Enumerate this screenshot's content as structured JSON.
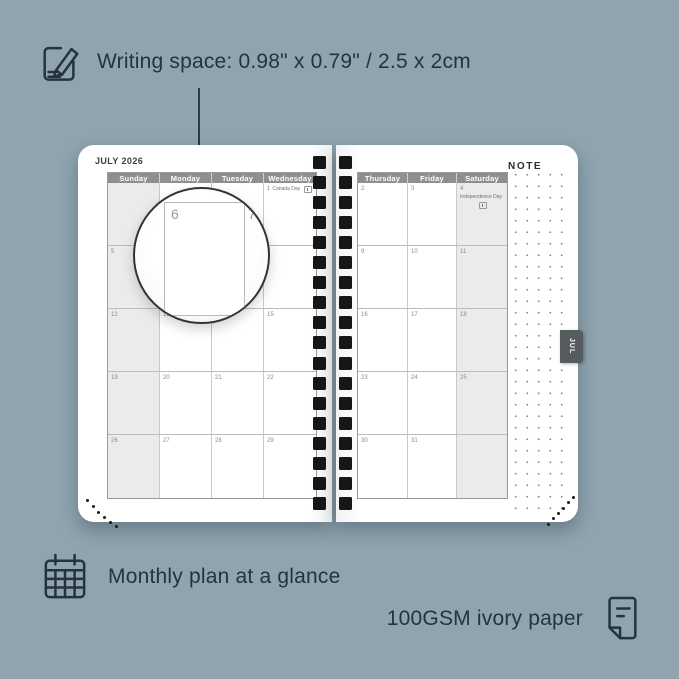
{
  "colors": {
    "background": "#8fa4af",
    "annotation_text": "#26333c",
    "header_bg": "#8f8f8f",
    "weekend_bg": "#ebebeb",
    "tab_bg": "#565b5e",
    "binding_hole": "#161616"
  },
  "annotations": {
    "writing_space": "Writing space: 0.98\" x 0.79\" / 2.5 x 2cm",
    "monthly_plan": "Monthly plan at a glance",
    "paper": "100GSM ivory paper"
  },
  "icons": {
    "top": "pencil-note-icon",
    "monthly": "calendar-grid-icon",
    "paper": "folded-paper-icon",
    "holiday": "flag-icon"
  },
  "planner": {
    "month_title": "JULY 2026",
    "note_label": "NOTE",
    "tab_label": "JUL",
    "left_page": {
      "headers": [
        "Sunday",
        "Monday",
        "Tuesday",
        "Wednesday"
      ],
      "weekend_col": 0,
      "rows": [
        [
          {
            "day": ""
          },
          {
            "day": ""
          },
          {
            "day": ""
          },
          {
            "day": "1",
            "holiday": "Canada Day",
            "flag": true
          }
        ],
        [
          {
            "day": "5"
          },
          {
            "day": "6"
          },
          {
            "day": "7"
          },
          {
            "day": "8"
          }
        ],
        [
          {
            "day": "12"
          },
          {
            "day": "13"
          },
          {
            "day": "14"
          },
          {
            "day": "15"
          }
        ],
        [
          {
            "day": "19"
          },
          {
            "day": "20"
          },
          {
            "day": "21"
          },
          {
            "day": "22"
          }
        ],
        [
          {
            "day": "26"
          },
          {
            "day": "27"
          },
          {
            "day": "28"
          },
          {
            "day": "29"
          }
        ]
      ]
    },
    "right_page": {
      "headers": [
        "Thursday",
        "Friday",
        "Saturday"
      ],
      "weekend_col": 2,
      "rows": [
        [
          {
            "day": "2"
          },
          {
            "day": "3"
          },
          {
            "day": "4",
            "holiday": "Independence Day",
            "flag": true
          }
        ],
        [
          {
            "day": "9"
          },
          {
            "day": "10"
          },
          {
            "day": "11"
          }
        ],
        [
          {
            "day": "16"
          },
          {
            "day": "17"
          },
          {
            "day": "18"
          }
        ],
        [
          {
            "day": "23"
          },
          {
            "day": "24"
          },
          {
            "day": "25"
          }
        ],
        [
          {
            "day": "30"
          },
          {
            "day": "31"
          },
          {
            "day": ""
          }
        ]
      ]
    },
    "magnifier": {
      "day": "6",
      "adjacent_day": "7"
    }
  }
}
